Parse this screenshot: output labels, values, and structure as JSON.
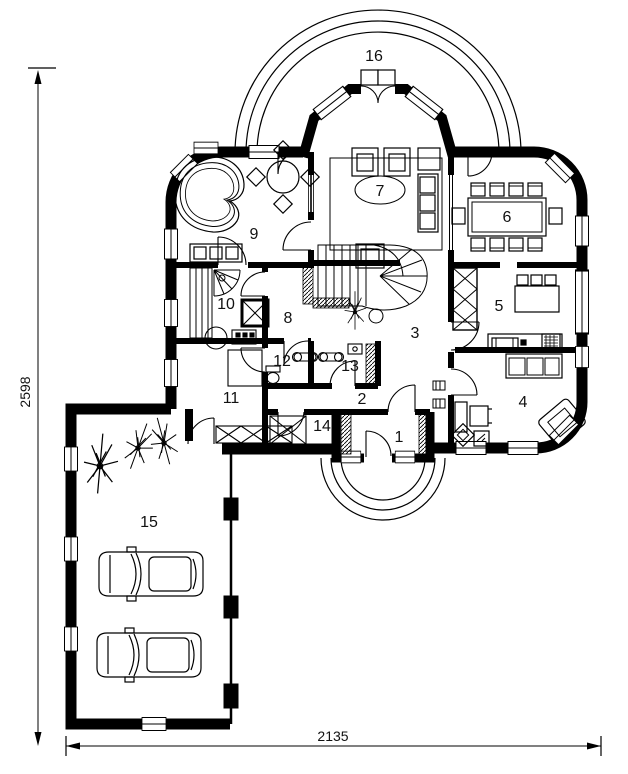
{
  "drawing": {
    "background": "#ffffff",
    "line_color": "#000000",
    "dimension_left": "2598",
    "dimension_bottom": "2135",
    "rooms": [
      {
        "label": "1"
      },
      {
        "label": "2"
      },
      {
        "label": "3"
      },
      {
        "label": "4"
      },
      {
        "label": "5"
      },
      {
        "label": "6"
      },
      {
        "label": "7"
      },
      {
        "label": "8"
      },
      {
        "label": "9"
      },
      {
        "label": "10"
      },
      {
        "label": "11"
      },
      {
        "label": "12"
      },
      {
        "label": "13"
      },
      {
        "label": "14"
      },
      {
        "label": "15"
      },
      {
        "label": "16"
      }
    ]
  }
}
